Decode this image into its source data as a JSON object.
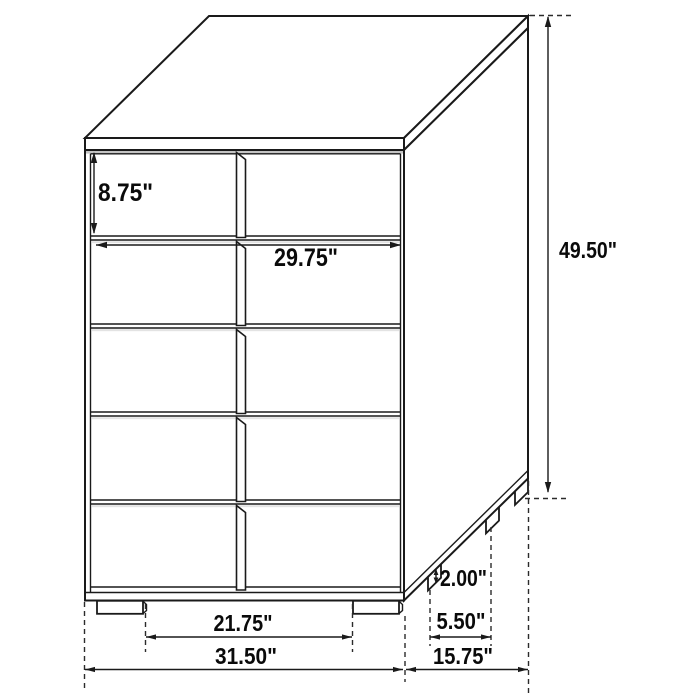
{
  "diagram": {
    "type": "furniture-dimension-drawing",
    "subject": "5-drawer chest",
    "units": "inches",
    "background_color": "#ffffff",
    "line_color": "#1a1a1a",
    "drawer_rows": 5,
    "dimensions": {
      "drawer_height": {
        "label": "8.75\"",
        "value": 8.75
      },
      "drawer_width": {
        "label": "29.75\"",
        "value": 29.75
      },
      "overall_height": {
        "label": "49.50\"",
        "value": 49.5
      },
      "leg_height": {
        "label": "2.00\"",
        "value": 2.0
      },
      "leg_spacing_depth": {
        "label": "5.50\"",
        "value": 5.5
      },
      "overall_depth": {
        "label": "15.75\"",
        "value": 15.75
      },
      "leg_spacing_width": {
        "label": "21.75\"",
        "value": 21.75
      },
      "overall_width": {
        "label": "31.50\"",
        "value": 31.5
      }
    }
  }
}
